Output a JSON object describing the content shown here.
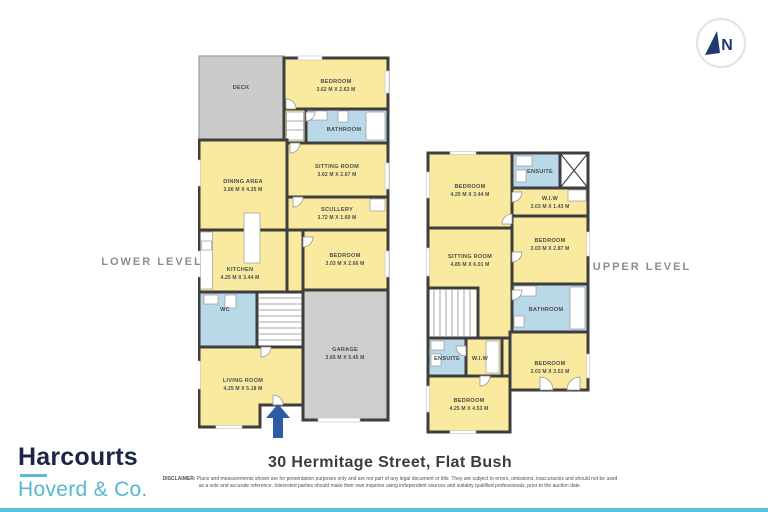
{
  "address": "30 Hermitage Street, Flat Bush",
  "disclaimer": {
    "label": "DISCLAIMER:",
    "text": "Plans and measurements shown are for presentation purposes only and are not part of any legal document or title. They are subject to errors, omissions, inaccuracies and should not be used as a sole and accurate reference. Interested parties should make their own inquiries using independent sources and suitably qualified professionals, prior to the auction date."
  },
  "branding": {
    "name": "Harcourts",
    "tagline": "Hoverd & Co."
  },
  "compass": {
    "label": "N"
  },
  "palette": {
    "room_fill": "#f9eaa0",
    "wet_room_fill": "#b9d8e8",
    "outdoor_fill": "#cecece",
    "wall": "#3e3e3e",
    "brand_navy": "#1d2546",
    "brand_teal": "#57bcd5",
    "entry_arrow_blue": "#2d5ba6",
    "level_title_gray": "#8d8d8d"
  },
  "lower": {
    "title": "LOWER LEVEL",
    "rooms": {
      "deck": {
        "label": "DECK"
      },
      "bedroom_top": {
        "label": "BEDROOM",
        "dims": "3.62 M X 2.63 M"
      },
      "bathroom": {
        "label": "BATHROOM"
      },
      "sitting_room": {
        "label": "SITTING ROOM",
        "dims": "3.62 M X 2.67 M"
      },
      "dining_area": {
        "label": "DINING AREA",
        "dims": "3.66 M X 4.25 M"
      },
      "scullery": {
        "label": "SCULLERY",
        "dims": "3.72 M X 1.60 M"
      },
      "kitchen": {
        "label": "KITCHEN",
        "dims": "4.25 M X 3.44 M"
      },
      "bedroom_mid": {
        "label": "BEDROOM",
        "dims": "3.03 M X 2.66 M"
      },
      "wc": {
        "label": "WC"
      },
      "garage": {
        "label": "GARAGE",
        "dims": "3.65 M X 5.45 M"
      },
      "living_room": {
        "label": "LIVING ROOM",
        "dims": "4.25 M X 5.18 M"
      }
    }
  },
  "upper": {
    "title": "UPPER LEVEL",
    "rooms": {
      "bedroom_nw": {
        "label": "BEDROOM",
        "dims": "4.25 M X 3.44 M"
      },
      "ensuite_top": {
        "label": "ENSUITE"
      },
      "wiw_top": {
        "label": "W.I.W",
        "dims": "3.03 M X 1.43 M"
      },
      "sitting_room": {
        "label": "SITTING ROOM",
        "dims": "4.85 M X 6.01 M"
      },
      "bedroom_e": {
        "label": "BEDROOM",
        "dims": "3.03 M X 2.87 M"
      },
      "bathroom": {
        "label": "BATHROOM"
      },
      "ensuite_bottom": {
        "label": "ENSUITE"
      },
      "wiw_bottom": {
        "label": "W.I.W"
      },
      "bedroom_se": {
        "label": "BEDROOM",
        "dims": "3.03 M X 3.52 M"
      },
      "bedroom_s": {
        "label": "BEDROOM",
        "dims": "4.25 M X 4.53 M"
      }
    }
  }
}
